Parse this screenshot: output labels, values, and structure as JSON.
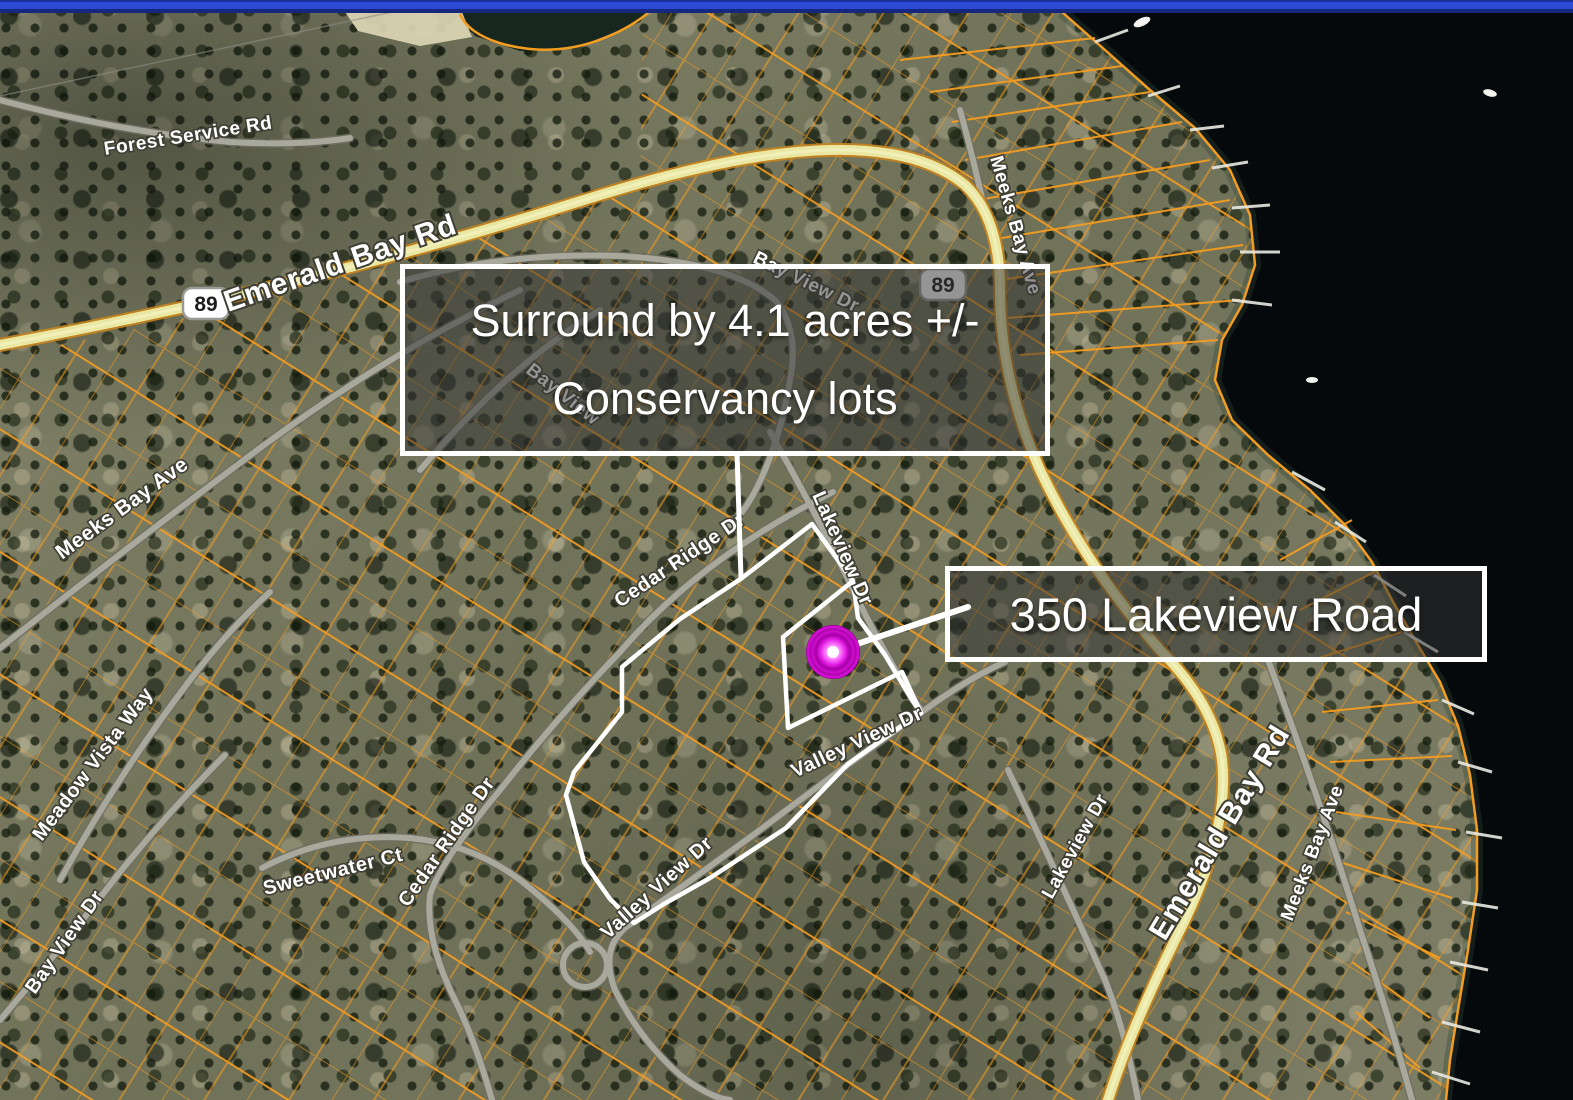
{
  "top_bar": {
    "color": "#2b4bd4"
  },
  "callouts": {
    "conservancy": {
      "line1": "Surround by 4.1 acres +/-",
      "line2": "Conservancy lots"
    },
    "address": {
      "label": "350 Lakeview Road"
    }
  },
  "route_shields": [
    {
      "number": "89"
    },
    {
      "number": "89"
    }
  ],
  "road_labels": [
    {
      "text": "Forest Service Rd"
    },
    {
      "text": "Emerald Bay Rd"
    },
    {
      "text": "Bay View Dr"
    },
    {
      "text": "Bay View"
    },
    {
      "text": "Meeks Bay Ave"
    },
    {
      "text": "Meeks Bay Ave"
    },
    {
      "text": "Cedar Ridge Dr"
    },
    {
      "text": "Lakeview Dr"
    },
    {
      "text": "Cedar Ridge Dr"
    },
    {
      "text": "Valley View Dr"
    },
    {
      "text": "Valley View Dr"
    },
    {
      "text": "Meadow Vista Way"
    },
    {
      "text": "Sweetwater Ct"
    },
    {
      "text": "Bay View Dr"
    },
    {
      "text": "Emerald Bay Rd"
    },
    {
      "text": "Meeks Bay Ave"
    },
    {
      "text": "Lakeview Dr"
    }
  ],
  "marker": {
    "description": "subject property location dot",
    "color": "#cc00cc"
  },
  "colors": {
    "parcel_line": "#f59d20",
    "highway_fill": "#e9e7a2",
    "road_fill": "#a8a89c",
    "water": "#06090c",
    "boundary": "#ffffff",
    "marker": "#cc00cc",
    "top_bar": "#2b4bd4"
  }
}
